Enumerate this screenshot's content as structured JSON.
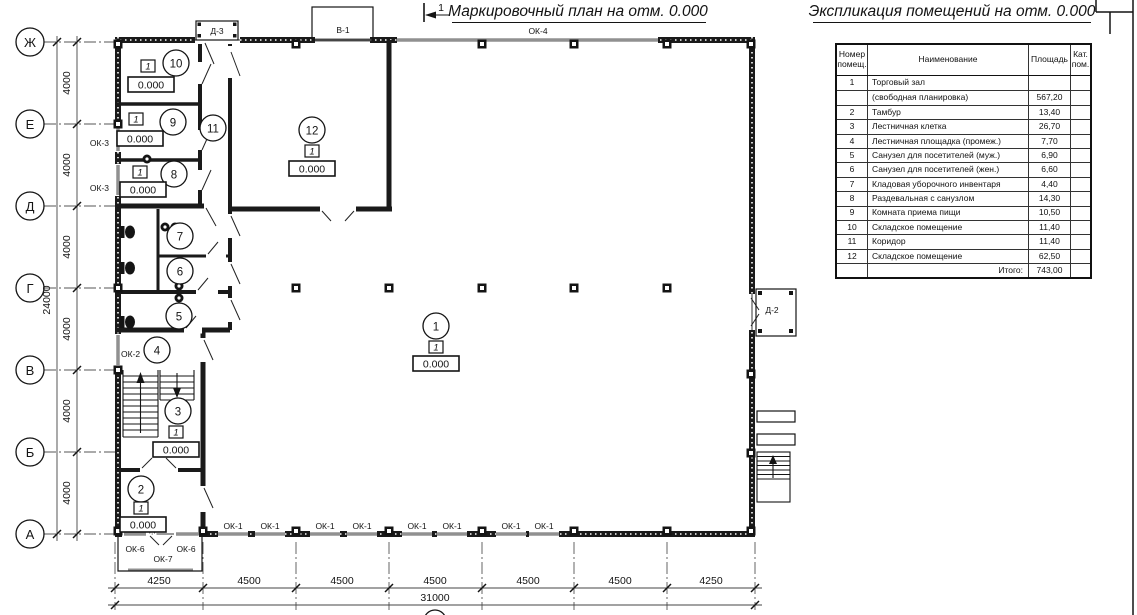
{
  "page": {
    "plan_title": "Маркировочный план на отм. 0.000",
    "table_title": "Экспликация помещений на отм. 0.000",
    "section_marker": "1",
    "ink_color": "#1a1a1a",
    "window_color": "#909090"
  },
  "axes": {
    "letters": [
      "Ж",
      "Е",
      "Д",
      "Г",
      "В",
      "Б",
      "А"
    ],
    "bottom_number": "1"
  },
  "dims": {
    "v_segments": [
      "4000",
      "4000",
      "4000",
      "4000",
      "4000",
      "4000"
    ],
    "v_total": "24000",
    "h_segments": [
      "4250",
      "4500",
      "4500",
      "4500",
      "4500",
      "4500",
      "4250"
    ],
    "h_total": "31000"
  },
  "labels": {
    "ok1": "ОК-1",
    "ok2": "ОК-2",
    "ok3": "ОК-3",
    "ok4": "ОК-4",
    "ok6": "ОК-6",
    "ok7": "ОК-7",
    "d1": "Д-1",
    "d2": "Д-2",
    "d3": "Д-3",
    "v1": "В-1"
  },
  "rooms": [
    {
      "number": "1",
      "mark": "1",
      "elevation": "0.000"
    },
    {
      "number": "2",
      "mark": "1",
      "elevation": "0.000"
    },
    {
      "number": "3",
      "mark": "1",
      "elevation": "0.000"
    },
    {
      "number": "4"
    },
    {
      "number": "5"
    },
    {
      "number": "6"
    },
    {
      "number": "7"
    },
    {
      "number": "8",
      "mark": "1",
      "elevation": "0.000"
    },
    {
      "number": "9",
      "mark": "1",
      "elevation": "0.000"
    },
    {
      "number": "10",
      "mark": "1",
      "elevation": "0.000"
    },
    {
      "number": "11"
    },
    {
      "number": "12",
      "mark": "1",
      "elevation": "0.000"
    }
  ],
  "table": {
    "headers": [
      "Номер помещ.",
      "Наименование",
      "Площадь",
      "Кат. пом."
    ],
    "rows": [
      {
        "num": "1",
        "name": "Торговый зал",
        "area": ""
      },
      {
        "num": "",
        "name": "(свободная планировка)",
        "area": "567,20"
      },
      {
        "num": "2",
        "name": "Тамбур",
        "area": "13,40"
      },
      {
        "num": "3",
        "name": "Лестничная клетка",
        "area": "26,70"
      },
      {
        "num": "4",
        "name": "Лестничная площадка (промеж.)",
        "area": "7,70"
      },
      {
        "num": "5",
        "name": "Санузел для посетителей (муж.)",
        "area": "6,90"
      },
      {
        "num": "6",
        "name": "Санузел для посетителей (жен.)",
        "area": "6,60"
      },
      {
        "num": "7",
        "name": "Кладовая уборочного инвентаря",
        "area": "4,40"
      },
      {
        "num": "8",
        "name": "Раздевальная с санузлом",
        "area": "14,30"
      },
      {
        "num": "9",
        "name": "Комната приема пищи",
        "area": "10,50"
      },
      {
        "num": "10",
        "name": "Складское помещение",
        "area": "11,40"
      },
      {
        "num": "11",
        "name": "Коридор",
        "area": "11,40"
      },
      {
        "num": "12",
        "name": "Складское помещение",
        "area": "62,50"
      },
      {
        "num": "",
        "name": "Итого:",
        "area": "743,00"
      }
    ]
  }
}
